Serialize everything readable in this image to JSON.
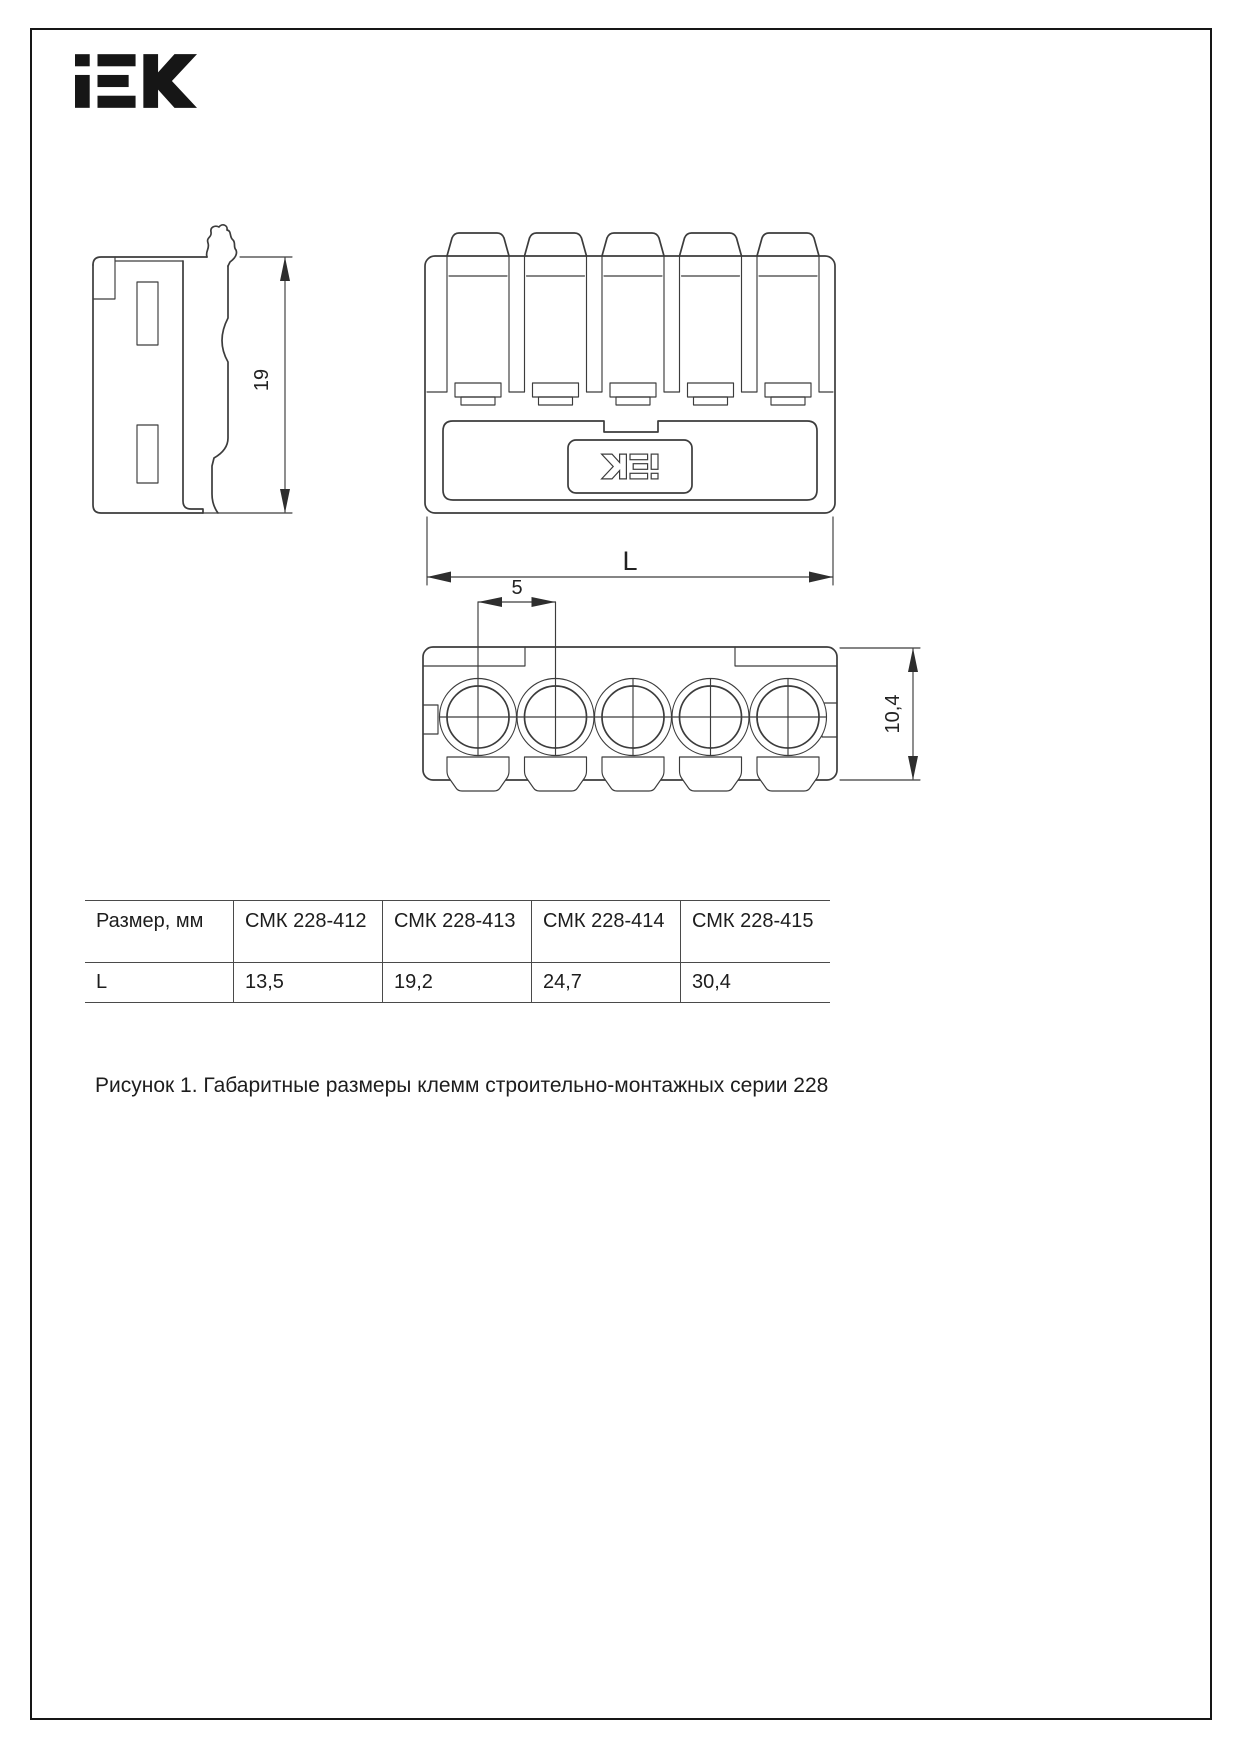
{
  "logo": {
    "brand": "iEK"
  },
  "drawings": {
    "side_view": {
      "height_dim": "19"
    },
    "front_view": {
      "length_dim": "L"
    },
    "top_view": {
      "pitch_dim": "5",
      "depth_dim": "10,4"
    }
  },
  "table": {
    "columns": [
      "Размер, мм",
      "СМК 228-412",
      "СМК 228-413",
      "СМК 228-414",
      "СМК 228-415"
    ],
    "rows": [
      [
        "L",
        "13,5",
        "19,2",
        "24,7",
        "30,4"
      ]
    ]
  },
  "caption": {
    "text": "Рисунок 1. Габаритные размеры клемм строительно-монтажных серии 228"
  },
  "colors": {
    "line": "#3c3c3c",
    "ink": "#161616",
    "table_border": "#4a4a4a"
  }
}
